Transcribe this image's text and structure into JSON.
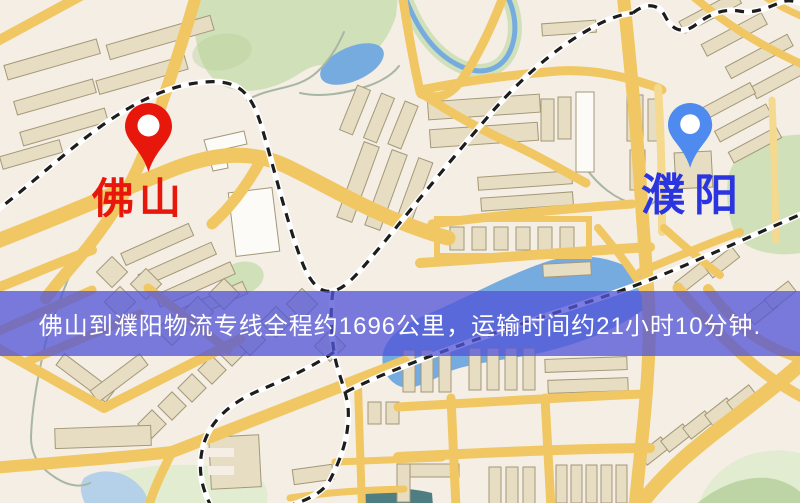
{
  "map": {
    "type": "logistics-route-map",
    "origin": {
      "name": "佛山"
    },
    "destination": {
      "name": "濮阳"
    },
    "banner": {
      "text": "佛山到濮阳物流专线全程约1696公里，运输时间约21小时10分钟."
    }
  },
  "icons": {
    "origin_pin": "map-pin-icon",
    "destination_pin": "map-pin-icon"
  },
  "theme": {
    "bg": "#f4eee5",
    "road": "#f0c763",
    "road_light": "#f5d98f",
    "building": "#e7ddc3",
    "building_stroke": "#a39878",
    "building_white": "#fcfbf7",
    "park": "#d0e0b8",
    "park_light": "#e2ecd0",
    "park_dark": "#b4cf98",
    "water": "#76abdf",
    "water_pale": "#b5d1ea",
    "water_dark": "#4e7e82",
    "stream": "#a8b6a4",
    "rail": "#1d1d1d",
    "rail_casing": "#ffffff",
    "origin_pin": "#e8170c",
    "origin_label": "#e8170c",
    "dest_pin": "#4f8bef",
    "dest_label": "#2a35e0",
    "banner_bg": "rgba(82,84,215,0.76)",
    "banner_text": "#ffffff"
  }
}
